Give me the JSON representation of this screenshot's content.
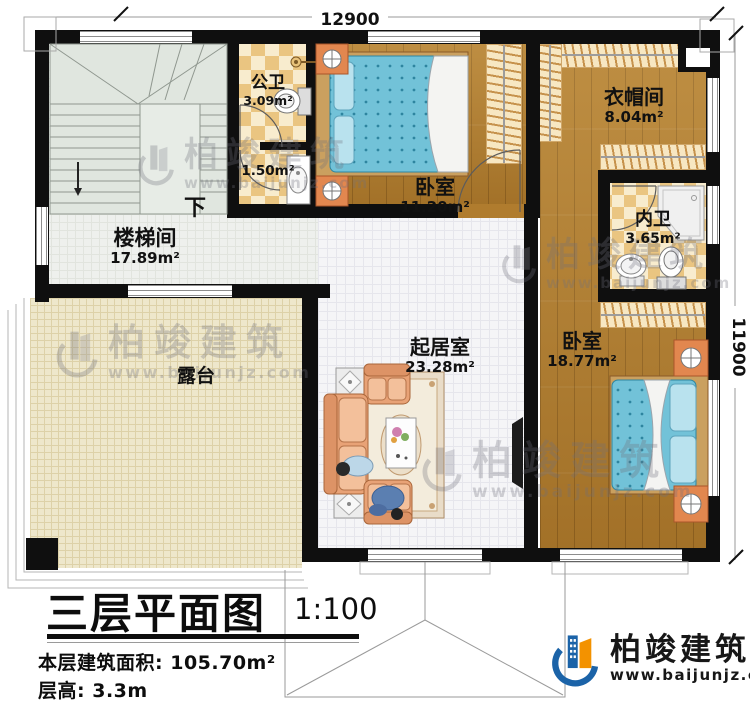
{
  "title": {
    "text": "三层平面图",
    "scale": "1:100"
  },
  "info": {
    "area_label": "本层建筑面积:",
    "area_value": "105.70m²",
    "floor_height_label": "层高:",
    "floor_height_value": "3.3m"
  },
  "dimensions": {
    "width": "12900",
    "height": "11900"
  },
  "rooms": {
    "staircase": {
      "name": "楼梯间",
      "area": "17.89m²"
    },
    "public_bath": {
      "name": "公卫",
      "area": "3.09m²"
    },
    "half_bath": {
      "area": "1.50m²"
    },
    "bedroom_top": {
      "name": "卧室",
      "area": "11.20m²"
    },
    "cloakroom": {
      "name": "衣帽间",
      "area": "8.04m²"
    },
    "inner_bath": {
      "name": "内卫",
      "area": "3.65m²"
    },
    "living": {
      "name": "起居室",
      "area": "23.28m²"
    },
    "bedroom_right": {
      "name": "卧室",
      "area": "18.77m²"
    },
    "terrace": {
      "name": "露台"
    }
  },
  "annotations": {
    "stair_down": "下"
  },
  "branding": {
    "name": "柏竣建筑",
    "url": "www.baijunjz.com"
  },
  "colors": {
    "wall": "#0f0f0f",
    "wood": "#b07c2e",
    "checker_dark": "#eac581",
    "checker_light": "#f8ecce",
    "terrace": "#eee7cb",
    "stairs": "#e0e6df",
    "bed_blue": "#72c2d8",
    "sofa": "#e8a276",
    "brand_blue": "#1b63a8",
    "brand_orange": "#f39200"
  }
}
